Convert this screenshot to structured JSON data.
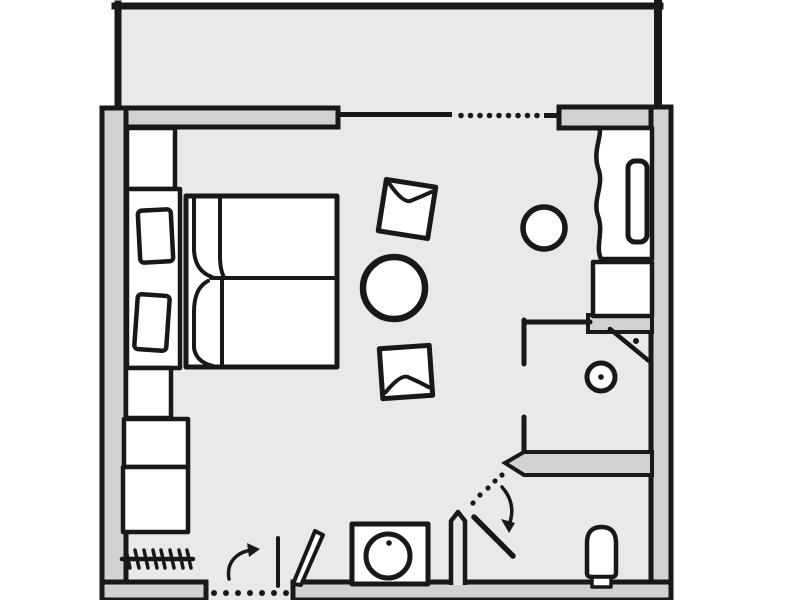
{
  "document": {
    "title": "Hand-drawn hotel room floor plan"
  },
  "colors": {
    "background": "#ffffff",
    "floor": "#e9e9e9",
    "wall": "#d2d2d2",
    "line": "#181818",
    "fixture": "#ffffff"
  },
  "rooms": [
    {
      "id": "balcony",
      "label": "Balcony"
    },
    {
      "id": "main-room",
      "label": "Bedroom / living area"
    },
    {
      "id": "shower-room",
      "label": "Shower room"
    },
    {
      "id": "wc",
      "label": "WC"
    }
  ],
  "items": [
    {
      "id": "double-bed",
      "label": "Double bed with two mattresses"
    },
    {
      "id": "pillows",
      "label": "Two pillows"
    },
    {
      "id": "headboard",
      "label": "Headboard panel"
    },
    {
      "id": "wardrobe",
      "label": "Wardrobe"
    },
    {
      "id": "cabinets",
      "label": "Cabinet units"
    },
    {
      "id": "radiator",
      "label": "Radiator"
    },
    {
      "id": "round-table",
      "label": "Round table"
    },
    {
      "id": "stool-upper",
      "label": "Seat cushion (upper)"
    },
    {
      "id": "stool-lower",
      "label": "Seat cushion (lower)"
    },
    {
      "id": "desk",
      "label": "Desk / sideboard with curtain edge"
    },
    {
      "id": "tv",
      "label": "TV on sideboard"
    },
    {
      "id": "desk-cabinet",
      "label": "Sideboard cabinet"
    },
    {
      "id": "desk-chair",
      "label": "Chair"
    },
    {
      "id": "corner-shower",
      "label": "Corner shower"
    },
    {
      "id": "washbasin-round",
      "label": "Round washbasin"
    },
    {
      "id": "toilet",
      "label": "Toilet"
    },
    {
      "id": "basin-unit",
      "label": "Washbasin vanity unit"
    },
    {
      "id": "entrance-door",
      "label": "Entrance door with swing arc"
    },
    {
      "id": "wc-door",
      "label": "Angled WC door with swing arc"
    },
    {
      "id": "balcony-door",
      "label": "Balcony sliding glass door (dotted opening)"
    }
  ]
}
